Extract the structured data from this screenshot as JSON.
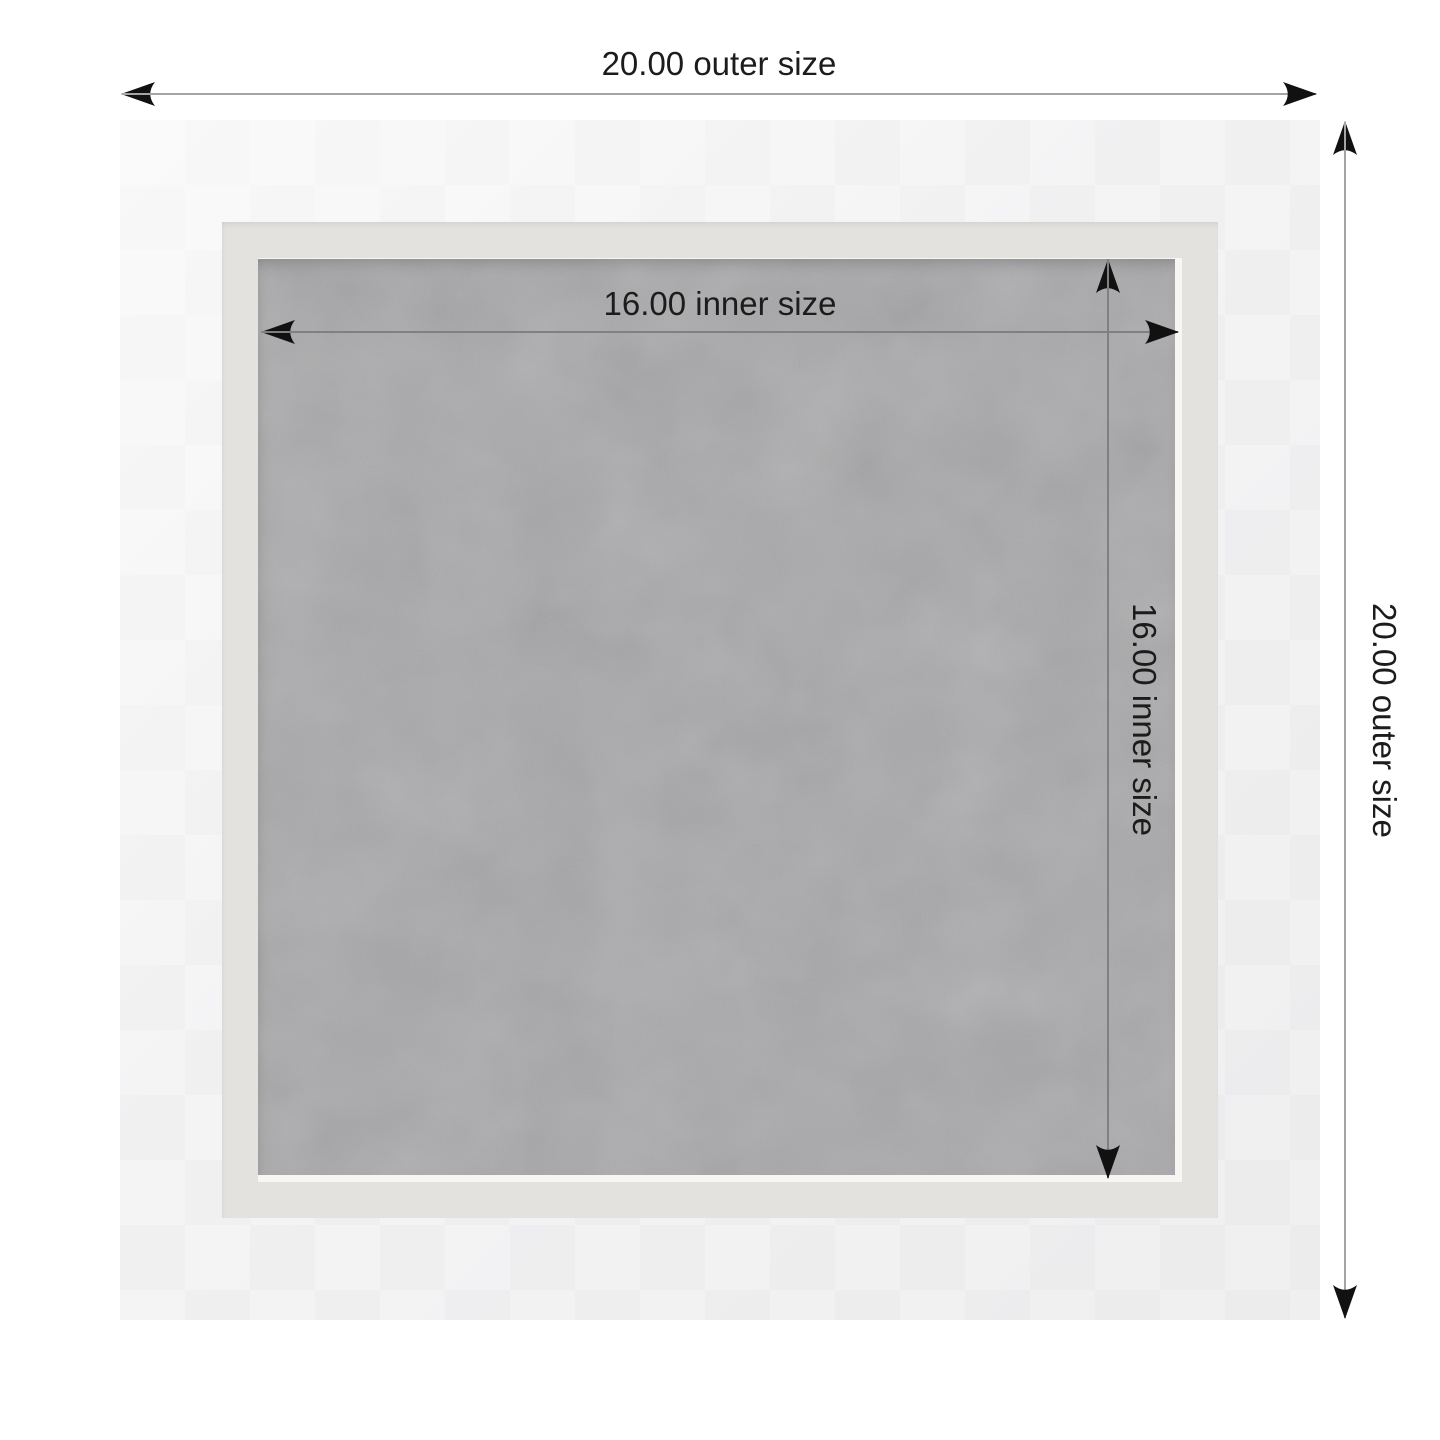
{
  "diagram": {
    "type": "framed-board-size-diagram",
    "outer_width_label": "20.00 outer size",
    "outer_height_label": "20.00 outer size",
    "inner_width_label": "16.00 inner size",
    "inner_height_label": "16.00 inner size",
    "measurements": {
      "outer_size": "20.00",
      "inner_size": "16.00"
    }
  },
  "colors": {
    "page_bg": "#ffffff",
    "frame_face": "#f4f4f5",
    "frame_bevel": "#e3e2de",
    "felt_liner": "#f7f6f3",
    "felt_gray": "#a8a8aa",
    "dim_line": "#a5a5a5",
    "dim_line_inner": "#808080",
    "arrow_black": "#111111",
    "label_text": "#1c1c1c"
  }
}
